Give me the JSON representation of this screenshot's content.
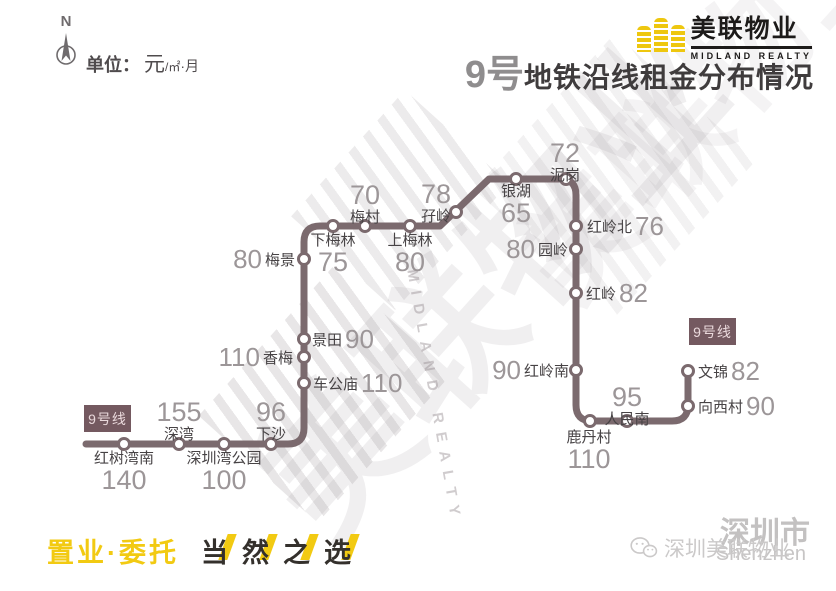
{
  "meta": {
    "north_letter": "N"
  },
  "unit": {
    "label": "单位：",
    "yuan": "元",
    "per": "/㎡",
    "month": "·月"
  },
  "brand": {
    "cn": "美联物业",
    "en": "MIDLAND REALTY",
    "logo_color": "#eec70f"
  },
  "title": {
    "prefix": "9号",
    "rest": "地铁沿线租金分布情况"
  },
  "line": {
    "badge": "9号线",
    "color": "#7b6a6e",
    "unit": "元/㎡·月",
    "stations": [
      {
        "name": "红树湾南",
        "price": "140"
      },
      {
        "name": "深湾",
        "price": "155"
      },
      {
        "name": "深圳湾公园",
        "price": "100"
      },
      {
        "name": "下沙",
        "price": "96"
      },
      {
        "name": "车公庙",
        "price": "110"
      },
      {
        "name": "香梅",
        "price": "110"
      },
      {
        "name": "景田",
        "price": "90"
      },
      {
        "name": "梅景",
        "price": "80"
      },
      {
        "name": "下梅林",
        "price": "75"
      },
      {
        "name": "梅村",
        "price": "70"
      },
      {
        "name": "上梅林",
        "price": "80"
      },
      {
        "name": "孖岭",
        "price": "78"
      },
      {
        "name": "银湖",
        "price": "65"
      },
      {
        "name": "泥岗",
        "price": "72"
      },
      {
        "name": "红岭北",
        "price": "76"
      },
      {
        "name": "园岭",
        "price": "80"
      },
      {
        "name": "红岭",
        "price": "82"
      },
      {
        "name": "红岭南",
        "price": "90"
      },
      {
        "name": "鹿丹村",
        "price": "110"
      },
      {
        "name": "人民南",
        "price": "95"
      },
      {
        "name": "向西村",
        "price": "90"
      },
      {
        "name": "文锦",
        "price": "82"
      }
    ]
  },
  "slogan": {
    "part1": "置业·委托",
    "part2_chars": [
      "当",
      "然",
      "之",
      "选"
    ]
  },
  "watermark": {
    "center_cn": "美联物业",
    "center_en": "MIDLAND REALTY",
    "city": "深圳市",
    "city_en": "Shenzhen",
    "account": "深圳美联物业"
  }
}
